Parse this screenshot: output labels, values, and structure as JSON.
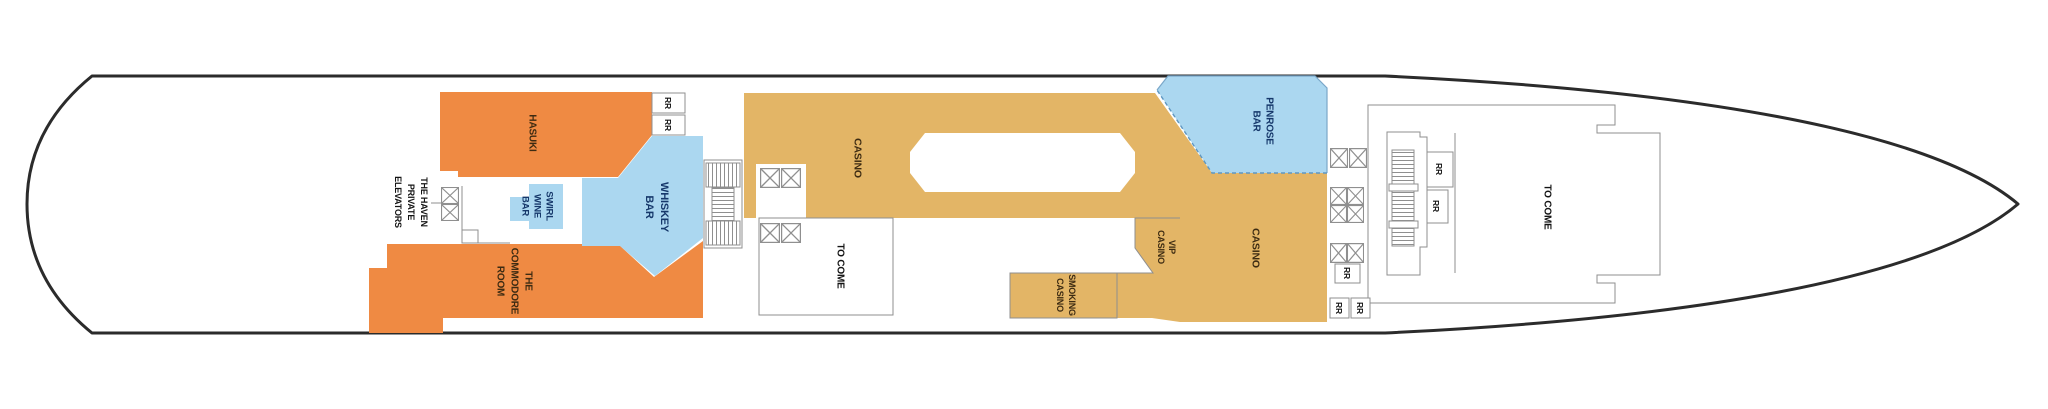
{
  "deck_plan": {
    "type": "cruise-ship-deck-plan",
    "labels": {
      "hasuki": "HASUKI",
      "haven": [
        "THE HAVEN",
        "PRIVATE",
        "ELEVATORS"
      ],
      "swirl": [
        "SWIRL",
        "WINE",
        "BAR"
      ],
      "whiskey": [
        "WHISKEY",
        "BAR"
      ],
      "commodore": [
        "THE",
        "COMMODORE",
        "ROOM"
      ],
      "casino_main": "CASINO",
      "to_come_mid": "TO COME",
      "vip": [
        "VIP",
        "CASINO"
      ],
      "smoking": [
        "SMOKING",
        "CASINO"
      ],
      "penrose": [
        "PENROSE",
        "BAR"
      ],
      "casino_right": "CASINO",
      "to_come_forward": "TO COME",
      "rr": "RR"
    },
    "icons": {
      "elevator": "square-with-x-cross",
      "stairs": "ladder-tread-hatching"
    },
    "colors": {
      "orange": "#EF8A43",
      "blue": "#ABD7F0",
      "tan": "#E3B566",
      "white": "#FFFFFF",
      "hull": "#2B2B2B",
      "outline": "#8F8F8F",
      "dash": "#5F97C2",
      "text_dark": "#3D2B12",
      "text_navy": "#16386B",
      "text_black": "#141414"
    }
  }
}
